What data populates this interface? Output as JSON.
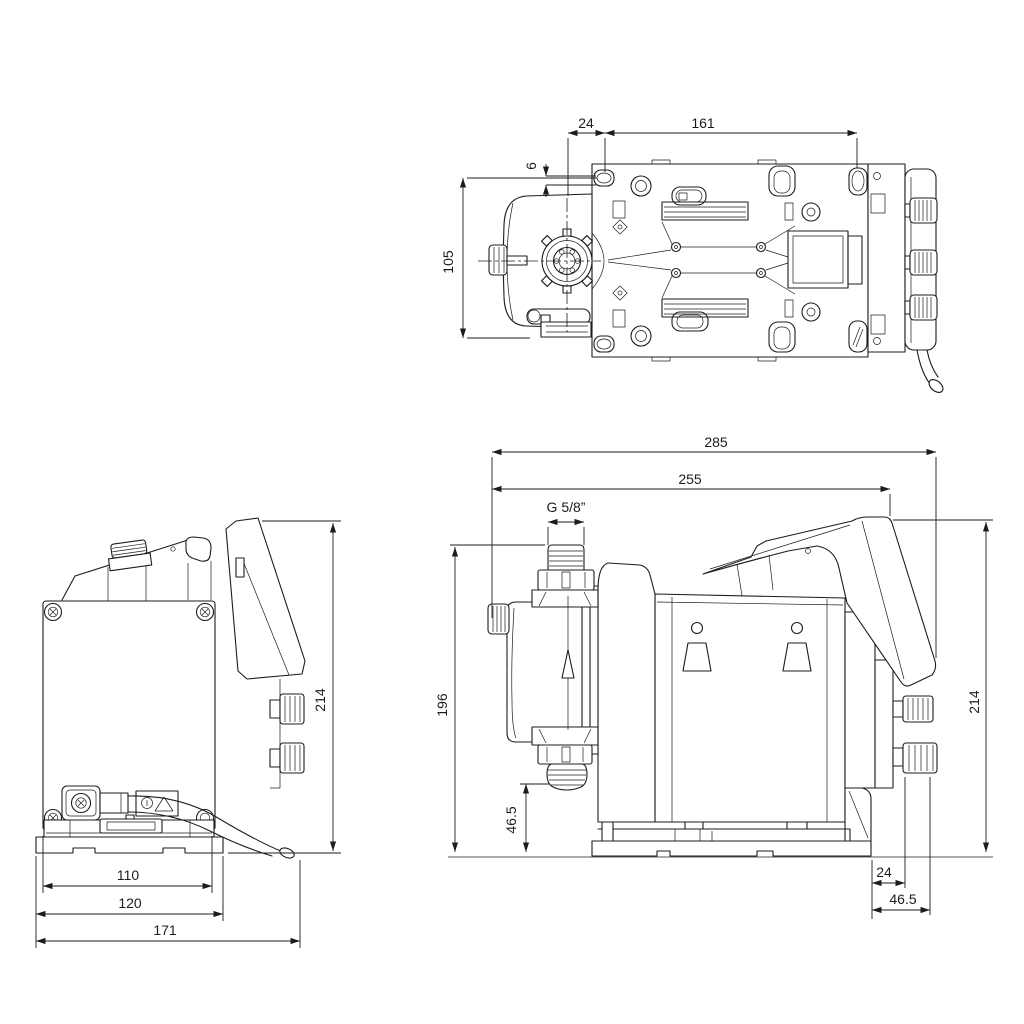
{
  "drawing": {
    "type": "technical-dimension-drawing",
    "subject": "diaphragm dosing pump, three orthographic views",
    "background_color": "#ffffff",
    "line_color": "#1c1c1c",
    "views": {
      "top": {
        "label": "top-view",
        "dims": {
          "d24": "24",
          "d161": "161",
          "d6": "6",
          "d105": "105"
        }
      },
      "back": {
        "label": "back-view",
        "dims": {
          "d214": "214",
          "d110": "110",
          "d120": "120",
          "d171": "171"
        }
      },
      "side": {
        "label": "side-view",
        "dims": {
          "d285": "285",
          "d255": "255",
          "thread": "G 5/8”",
          "d196": "196",
          "d465_left": "46.5",
          "d214": "214",
          "d24": "24",
          "d465_right": "46.5"
        }
      }
    }
  }
}
